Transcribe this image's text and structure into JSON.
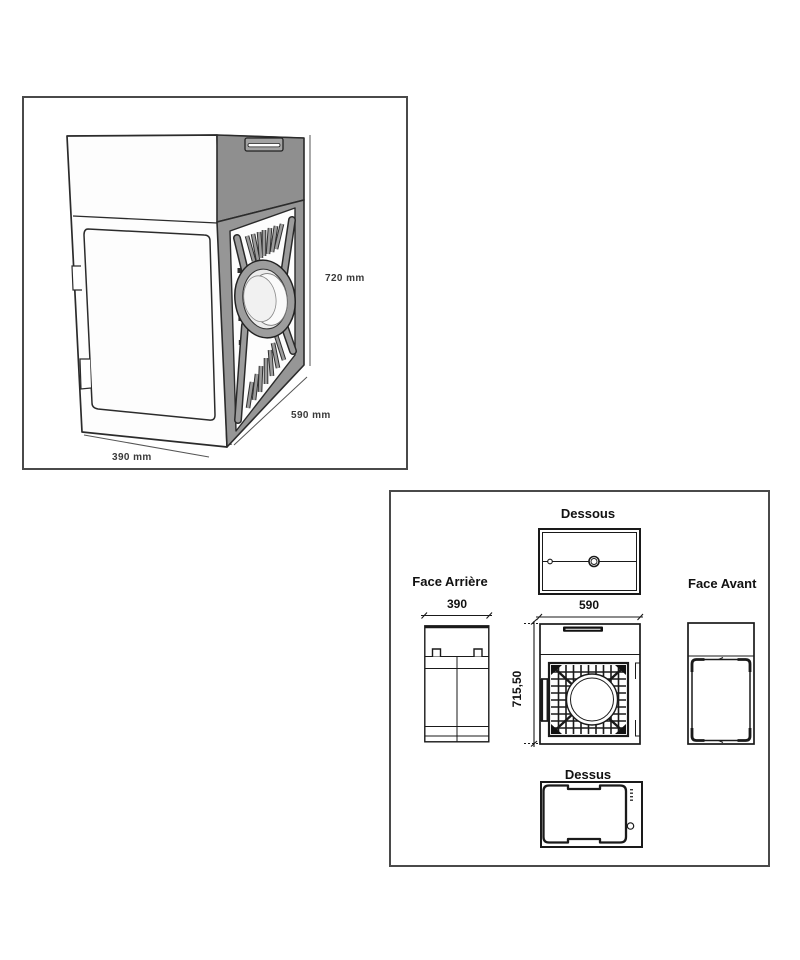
{
  "isometric_panel": {
    "dim_height": "720 mm",
    "dim_depth": "590 mm",
    "dim_width": "390 mm"
  },
  "views_panel": {
    "dessous_label": "Dessous",
    "rear_label": "Face Arrière",
    "front_label": "Face Avant",
    "dessus_label": "Dessus",
    "dim_rear_width": "390",
    "dim_side_width": "590",
    "dim_height": "715,50"
  },
  "colors": {
    "drawing_line": "#1a1a1a",
    "panel_border": "#4a4a4a",
    "side_face_gray": "#959595",
    "lid_gray": "#8f8f8f"
  }
}
